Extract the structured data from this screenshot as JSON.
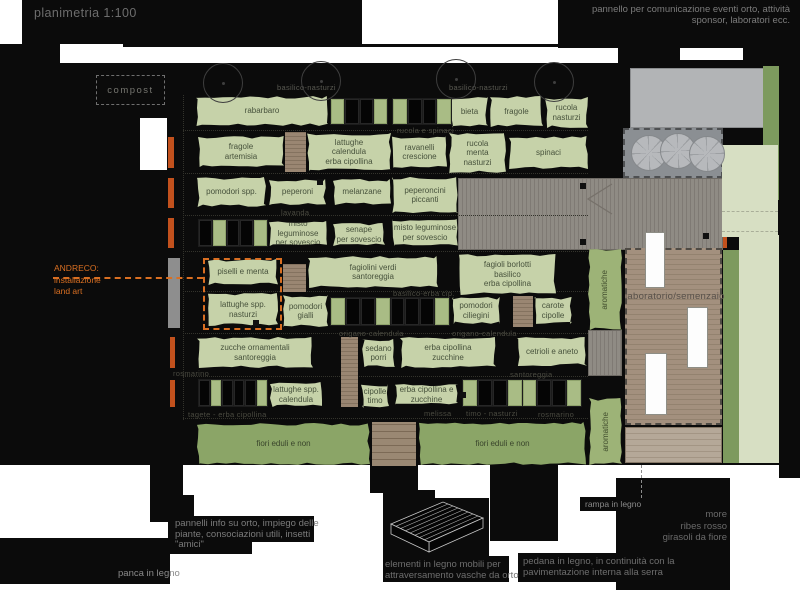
{
  "header": {
    "title": "planimetria 1:100",
    "top_right_note": "pannello per comunicazione eventi orto, attività\nsponsor, laboratori ecc."
  },
  "areas": {
    "compost": "compost",
    "laboratorio": "laboratorio/semenzaio"
  },
  "andreco_note": "ANDRECO:\ninstallazione\nland art",
  "notes": {
    "pannelli": "pannelli info su orto, impiego delle\npiante, consociazioni utili, insetti\n\"amici\"",
    "panca": "panca in legno",
    "elementi": "elementi in legno mobili per\nattraversamento vasche da orto",
    "pedana": "pedana in legno, in continuità con la\npavimentazione interna alla serra",
    "rampa": "rampa in legno",
    "frutti": "more\nribes rosso\ngirasoli da fiore"
  },
  "colors": {
    "bed_green": "#c6d2a9",
    "flower_green": "#8ba567",
    "aromatic_green": "#9db377",
    "hedge_green": "#7d9a5e",
    "lawn_green": "#d7dfc3",
    "terrace_gray": "#b2b4b6",
    "accent_orange": "#d96f22",
    "accent_red": "#c2511d",
    "faint_label": "#4a4a40"
  },
  "beds": [
    {
      "label": "rabarbaro",
      "x": 196,
      "y": 96,
      "w": 132,
      "h": 30,
      "kind": "standard"
    },
    {
      "label": "bieta",
      "x": 451,
      "y": 97,
      "w": 37,
      "h": 30,
      "kind": "standard"
    },
    {
      "label": "fragole",
      "x": 490,
      "y": 96,
      "w": 53,
      "h": 31,
      "kind": "standard"
    },
    {
      "label": "rucola\nnasturzi",
      "x": 545,
      "y": 97,
      "w": 43,
      "h": 31,
      "kind": "standard"
    },
    {
      "label": "fragole\nartemisia",
      "x": 198,
      "y": 136,
      "w": 86,
      "h": 31,
      "kind": "standard"
    },
    {
      "label": "lattughe\ncalendula\nerba cipollina",
      "x": 307,
      "y": 133,
      "w": 84,
      "h": 38,
      "kind": "standard"
    },
    {
      "label": "ravanelli\ncrescione",
      "x": 392,
      "y": 136,
      "w": 55,
      "h": 32,
      "kind": "standard"
    },
    {
      "label": "rucola\nmenta\nnasturzi",
      "x": 449,
      "y": 133,
      "w": 57,
      "h": 40,
      "kind": "standard"
    },
    {
      "label": "spinaci",
      "x": 509,
      "y": 136,
      "w": 79,
      "h": 33,
      "kind": "standard"
    },
    {
      "label": "pomodori spp.",
      "x": 197,
      "y": 177,
      "w": 69,
      "h": 30,
      "kind": "standard"
    },
    {
      "label": "peperoni",
      "x": 269,
      "y": 179,
      "w": 57,
      "h": 26,
      "kind": "standard"
    },
    {
      "label": "melanzane",
      "x": 333,
      "y": 179,
      "w": 58,
      "h": 26,
      "kind": "standard"
    },
    {
      "label": "peperoncini\npiccanti",
      "x": 392,
      "y": 177,
      "w": 66,
      "h": 36,
      "kind": "standard"
    },
    {
      "label": "misto leguminose\nper sovescio",
      "x": 269,
      "y": 221,
      "w": 58,
      "h": 25,
      "kind": "standard"
    },
    {
      "label": "senape\nper sovescio",
      "x": 333,
      "y": 223,
      "w": 52,
      "h": 23,
      "kind": "standard"
    },
    {
      "label": "misto leguminose\nper sovescio",
      "x": 392,
      "y": 219,
      "w": 66,
      "h": 27,
      "kind": "standard"
    },
    {
      "label": "piselli e menta",
      "x": 208,
      "y": 259,
      "w": 70,
      "h": 26,
      "kind": "standard"
    },
    {
      "label": "fagiolini verdi\nsantoreggia",
      "x": 308,
      "y": 256,
      "w": 130,
      "h": 32,
      "kind": "standard"
    },
    {
      "label": "fagioli borlotti\nbasilico\nerba cipollina",
      "x": 459,
      "y": 254,
      "w": 97,
      "h": 41,
      "kind": "standard"
    },
    {
      "label": "lattughe spp.\nnasturzi",
      "x": 208,
      "y": 293,
      "w": 70,
      "h": 33,
      "kind": "standard"
    },
    {
      "label": "pomodori\ngialli",
      "x": 283,
      "y": 295,
      "w": 45,
      "h": 32,
      "kind": "standard"
    },
    {
      "label": "pomodori\nciliegini",
      "x": 452,
      "y": 297,
      "w": 48,
      "h": 27,
      "kind": "standard"
    },
    {
      "label": "carote\ncipolle",
      "x": 534,
      "y": 297,
      "w": 38,
      "h": 27,
      "kind": "standard"
    },
    {
      "label": "zucche ornamentali\nsantoreggia",
      "x": 197,
      "y": 337,
      "w": 116,
      "h": 31,
      "kind": "standard"
    },
    {
      "label": "sedano\nporri",
      "x": 362,
      "y": 339,
      "w": 33,
      "h": 28,
      "kind": "standard"
    },
    {
      "label": "erba cipollina\nzucchine",
      "x": 400,
      "y": 337,
      "w": 96,
      "h": 31,
      "kind": "standard"
    },
    {
      "label": "cetrioli e aneto",
      "x": 517,
      "y": 337,
      "w": 70,
      "h": 29,
      "kind": "standard"
    },
    {
      "label": "lattughe spp.\ncalendula",
      "x": 270,
      "y": 382,
      "w": 52,
      "h": 25,
      "kind": "standard"
    },
    {
      "label": "cipolle\ntimo",
      "x": 361,
      "y": 384,
      "w": 28,
      "h": 24,
      "kind": "standard"
    },
    {
      "label": "erba cipollina e\nzucchine",
      "x": 395,
      "y": 384,
      "w": 63,
      "h": 21,
      "kind": "standard"
    },
    {
      "label": "fiori eduli e non",
      "x": 197,
      "y": 423,
      "w": 173,
      "h": 42,
      "kind": "flower"
    },
    {
      "label": "fiori eduli e non",
      "x": 419,
      "y": 422,
      "w": 167,
      "h": 43,
      "kind": "flower"
    },
    {
      "label": "aromatiche",
      "x": 588,
      "y": 249,
      "w": 34,
      "h": 81,
      "kind": "aromatic"
    },
    {
      "label": "aromatiche",
      "x": 589,
      "y": 398,
      "w": 33,
      "h": 67,
      "kind": "aromatic"
    }
  ],
  "planters": [
    {
      "x": 330,
      "y": 98,
      "w": 58,
      "h": 27,
      "cells": [
        1,
        0,
        0,
        1
      ]
    },
    {
      "x": 392,
      "y": 98,
      "w": 60,
      "h": 27,
      "cells": [
        1,
        0,
        0,
        1
      ]
    },
    {
      "x": 198,
      "y": 219,
      "w": 70,
      "h": 28,
      "cells": [
        0,
        1,
        0,
        0,
        1
      ]
    },
    {
      "x": 330,
      "y": 297,
      "w": 120,
      "h": 29,
      "cells": [
        1,
        0,
        0,
        1,
        0,
        0,
        0,
        1
      ]
    },
    {
      "x": 198,
      "y": 379,
      "w": 70,
      "h": 28,
      "cells": [
        0,
        1,
        0,
        0,
        0,
        1
      ]
    },
    {
      "x": 462,
      "y": 379,
      "w": 120,
      "h": 28,
      "cells": [
        1,
        0,
        0,
        1,
        1,
        0,
        0,
        1
      ]
    }
  ],
  "walkways": [
    {
      "x": 285,
      "y": 132,
      "w": 21,
      "h": 40,
      "wide": false
    },
    {
      "x": 283,
      "y": 264,
      "w": 23,
      "h": 28,
      "wide": false
    },
    {
      "x": 513,
      "y": 296,
      "w": 20,
      "h": 31,
      "wide": false
    },
    {
      "x": 341,
      "y": 337,
      "w": 17,
      "h": 70,
      "wide": false
    },
    {
      "x": 372,
      "y": 422,
      "w": 44,
      "h": 44,
      "wide": true
    }
  ],
  "faint_labels": [
    {
      "text": "basilico-nasturzi",
      "x": 277,
      "y": 83,
      "c": "#5a5a52"
    },
    {
      "text": "basilico-nasturzi",
      "x": 449,
      "y": 83,
      "c": "#5a5a52"
    },
    {
      "text": "rucola e spinaci",
      "x": 397,
      "y": 126
    },
    {
      "text": "lavanda",
      "x": 281,
      "y": 208
    },
    {
      "text": "basilico-erba cip.",
      "x": 393,
      "y": 289
    },
    {
      "text": "origano-calendula",
      "x": 339,
      "y": 329
    },
    {
      "text": "origano-calendula",
      "x": 452,
      "y": 329
    },
    {
      "text": "rosmarino",
      "x": 173,
      "y": 369
    },
    {
      "text": "santoreggia",
      "x": 510,
      "y": 370
    },
    {
      "text": "tagete - erba cipollina",
      "x": 188,
      "y": 410
    },
    {
      "text": "melissa",
      "x": 424,
      "y": 409
    },
    {
      "text": "timo - nasturzi",
      "x": 466,
      "y": 409
    },
    {
      "text": "rosmarino",
      "x": 538,
      "y": 410
    }
  ],
  "orange_bars": [
    {
      "x": 168,
      "y": 137,
      "w": 6,
      "h": 31
    },
    {
      "x": 168,
      "y": 178,
      "w": 6,
      "h": 30
    },
    {
      "x": 168,
      "y": 218,
      "w": 6,
      "h": 30
    },
    {
      "x": 170,
      "y": 337,
      "w": 5,
      "h": 31
    },
    {
      "x": 170,
      "y": 380,
      "w": 5,
      "h": 27
    }
  ],
  "trees": [
    {
      "x": 222,
      "y": 82
    },
    {
      "x": 320,
      "y": 80
    },
    {
      "x": 455,
      "y": 78
    },
    {
      "x": 553,
      "y": 81
    }
  ],
  "canopies": [
    {
      "x": 648,
      "y": 152
    },
    {
      "x": 677,
      "y": 150
    },
    {
      "x": 706,
      "y": 153
    }
  ],
  "tables": [
    {
      "x": 645,
      "y": 232,
      "w": 20,
      "h": 56
    },
    {
      "x": 687,
      "y": 307,
      "w": 21,
      "h": 61
    },
    {
      "x": 645,
      "y": 353,
      "w": 22,
      "h": 62
    }
  ],
  "posts": [
    {
      "x": 580,
      "y": 183
    },
    {
      "x": 580,
      "y": 239
    },
    {
      "x": 703,
      "y": 233
    },
    {
      "x": 317,
      "y": 179
    },
    {
      "x": 253,
      "y": 320
    },
    {
      "x": 460,
      "y": 392
    }
  ]
}
